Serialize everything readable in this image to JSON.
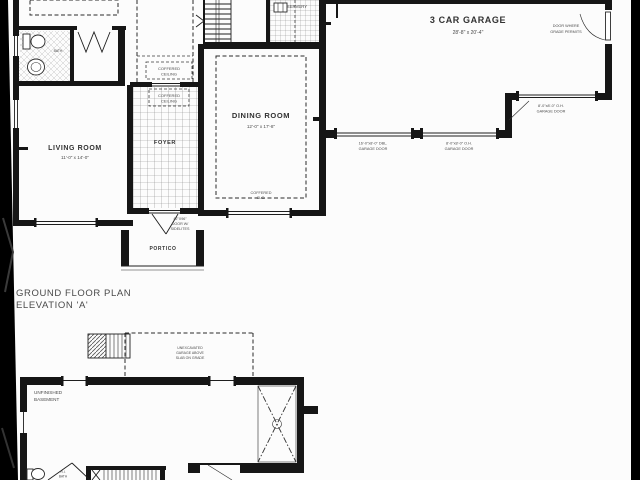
{
  "plan": {
    "title": {
      "line1": "GROUND FLOOR PLAN",
      "line2": "ELEVATION 'A'"
    },
    "ground_floor": {
      "living_room": {
        "label": "LIVING ROOM",
        "dims": "11'-0\" x 14'-0\""
      },
      "dining_room": {
        "label": "DINING ROOM",
        "dims": "12'-0\" x 17'-8\""
      },
      "foyer": {
        "label": "FOYER"
      },
      "portico": {
        "label": "PORTICO"
      },
      "servery": {
        "label": "SERVERY"
      },
      "bath": {
        "label": "BATH"
      },
      "garage": {
        "label": "3 CAR GARAGE",
        "dims": "28'-8\" x 20'-4\""
      },
      "notes": {
        "coffered_hall": {
          "line1": "COFFERED",
          "line2": "CEILING"
        },
        "coffered_foyer": {
          "line1": "COFFERED",
          "line2": "CEILING"
        },
        "coffered_dining": {
          "line1": "COFFERED",
          "line2": "CLG."
        },
        "front_door": {
          "line1": "42\"X96\"",
          "line2": "DOOR W/",
          "line3": "SIDELITES"
        },
        "grade_door": {
          "line1": "DOOR WHERE",
          "line2": "GRADE PERMITS"
        },
        "garage_door_double": {
          "line1": "16'-0\"x8'-0\" DBL.",
          "line2": "GARAGE DOOR"
        },
        "garage_door_single": {
          "line1": "8'-0\"x8'-0\" O.H.",
          "line2": "GARAGE DOOR"
        },
        "garage_door_side": {
          "line1": "8'-0\"x8'-0\" O.H.",
          "line2": "GARAGE DOOR"
        }
      }
    },
    "basement": {
      "unfinished": {
        "line1": "UNFINISHED",
        "line2": "BASEMENT"
      },
      "notes": {
        "unexcavated": {
          "line1": "UNEXCAVATED",
          "line2": "GARAGE ABOVE",
          "line3": "SLAB ON GRADE"
        },
        "rough_in": {
          "line1": "R.I.",
          "line2": "BATH"
        }
      }
    },
    "colors": {
      "paper": "#fcfcfc",
      "ink": "#1b1b1b",
      "background": "#000000"
    }
  }
}
